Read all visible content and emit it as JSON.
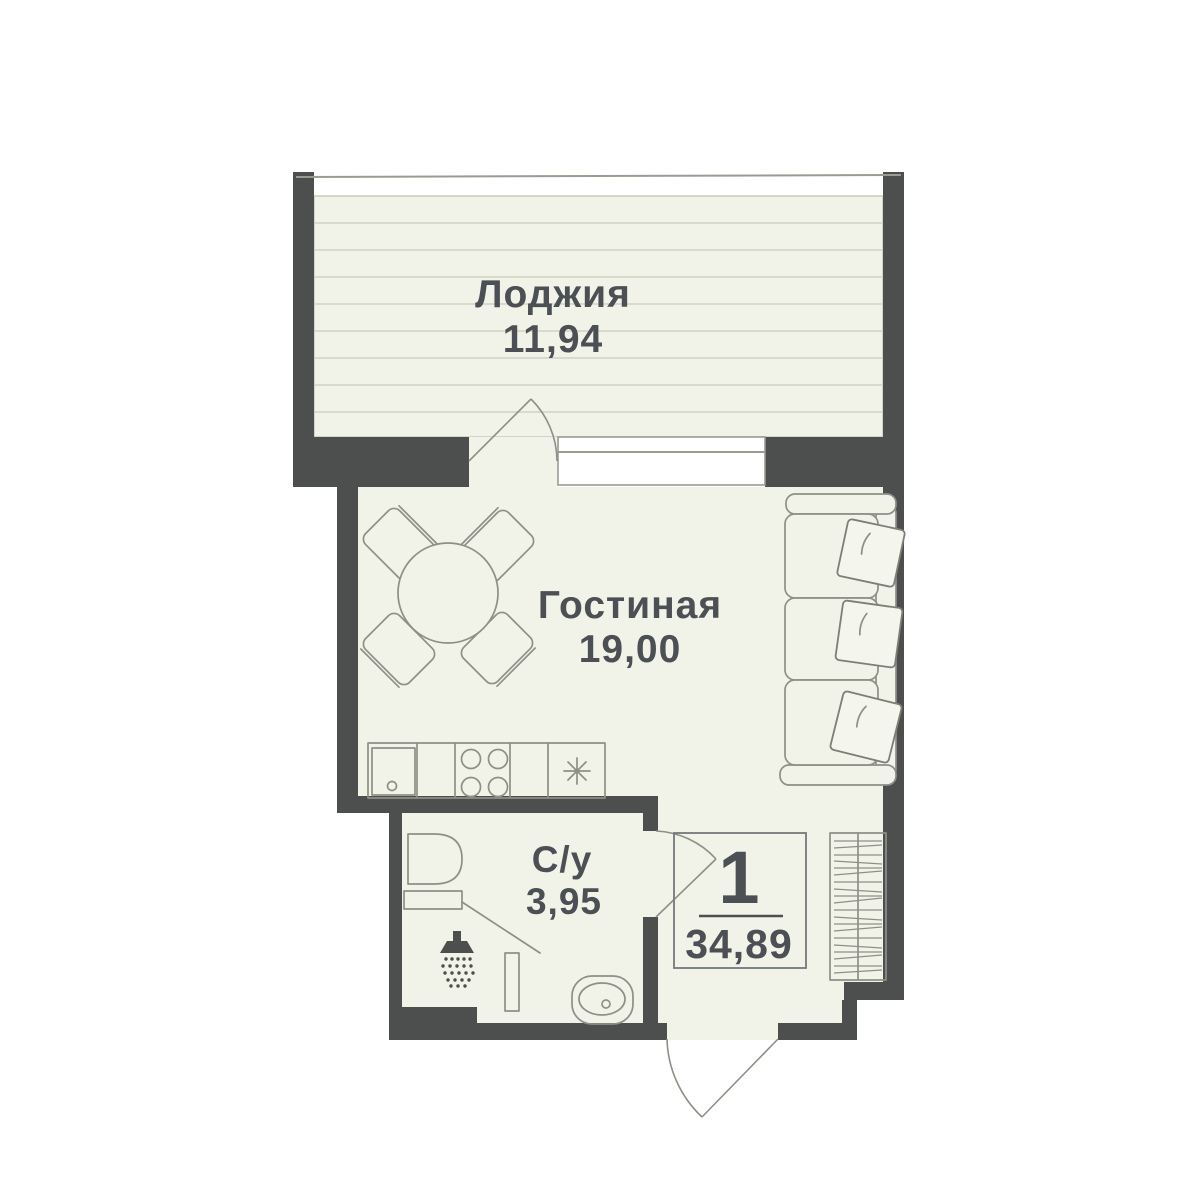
{
  "plan": {
    "title": "Apartment floor plan",
    "rooms": [
      {
        "id": "loggia",
        "label": "Лоджия",
        "area": "11,94"
      },
      {
        "id": "living-room",
        "label": "Гостиная",
        "area": "19,00"
      },
      {
        "id": "bathroom",
        "label": "С/у",
        "area": "3,95"
      }
    ],
    "info_box": {
      "rooms_count": "1",
      "total_area": "34,89"
    },
    "colors": {
      "wall": "#4d4e4e",
      "floor": "#f1f2e8",
      "furniture_outline": "#8e8f86",
      "loggia_hatch": "#d9dacb",
      "label_text": "#4c5055",
      "background": "#ffffff"
    }
  }
}
